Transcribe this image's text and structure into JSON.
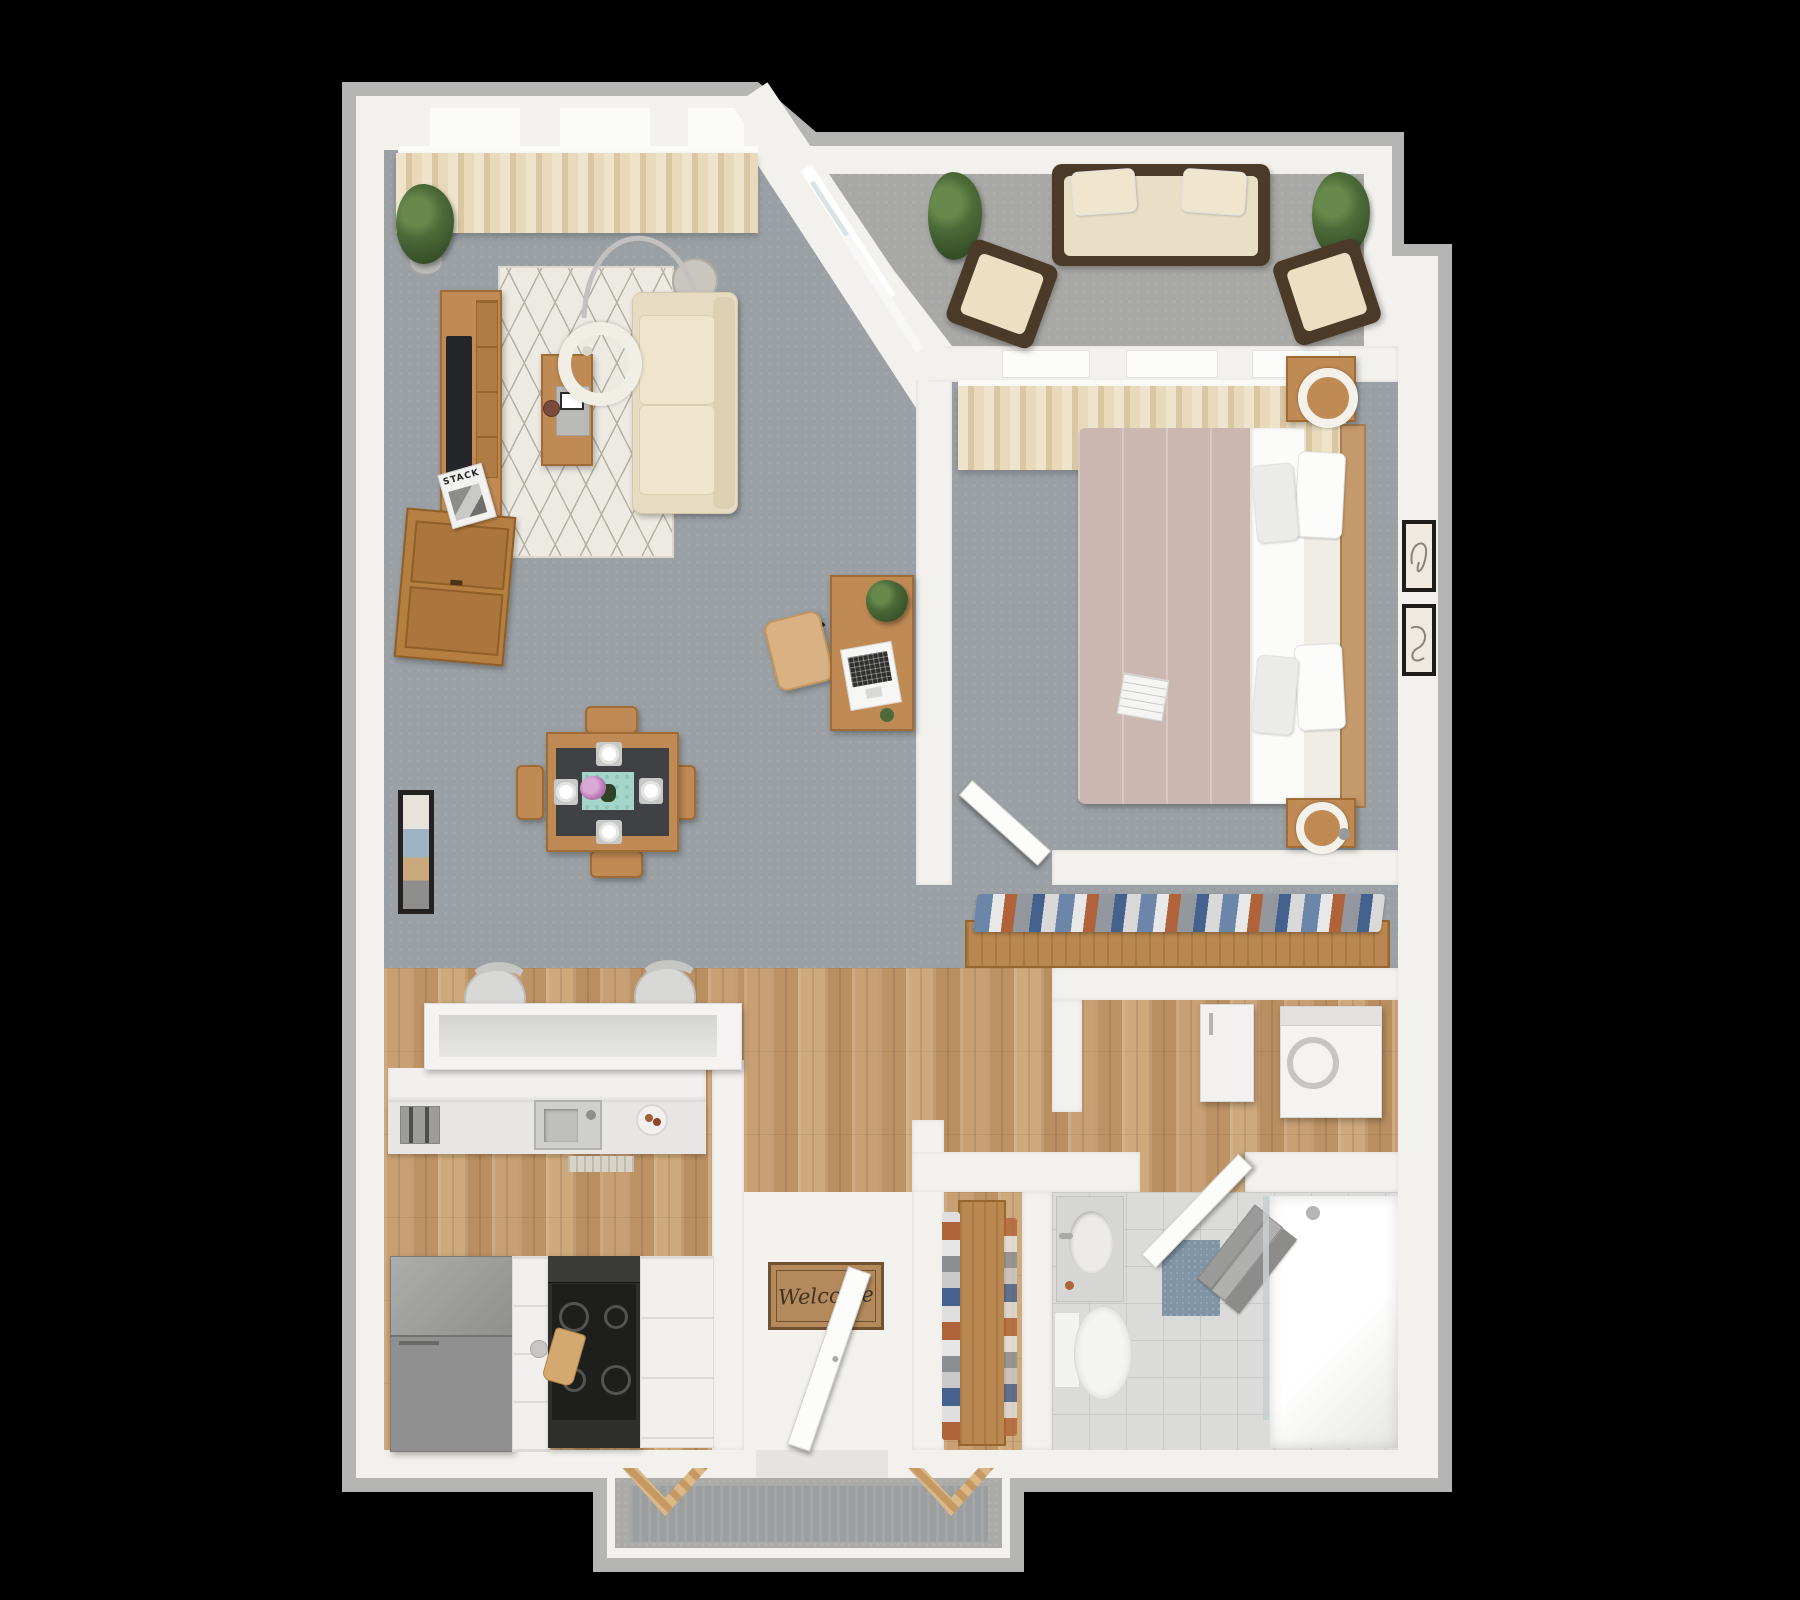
{
  "canvas": {
    "width": 1800,
    "height": 1600,
    "background": "#000000"
  },
  "labels": {
    "welcome_mat": "Welcome",
    "magazine_masthead": "STACK"
  },
  "palette": {
    "exterior_band": "#b5b5b3",
    "interior_wall": "#f3f1ee",
    "carpet_gray": "#9aa0a4",
    "balcony_carpet": "#a8a8a6",
    "wood_floor": "#c49a6e",
    "bathroom_tile": "#dbdbd9",
    "patio_concrete": "#ababa9",
    "wood_furniture": "#c08a54",
    "sofa_cream": "#eae0c8",
    "curtain_beige": "#e7d9ba",
    "duvet_mauve": "#cbb6b0",
    "runner_teal": "#a5d5c9",
    "bath_mat_blue": "#8195a6",
    "wicker_brown": "#4c3a28",
    "stove_black": "#1e1e1c",
    "appliance_gray": "#909090"
  },
  "scene": {
    "type": "3d-floor-plan-render",
    "view": "top-down"
  },
  "rooms": {
    "living_room": [
      "curtained-windows",
      "potted-plant",
      "tv-console",
      "tv",
      "magazine-stack",
      "sideboard",
      "area-rug",
      "coffee-table",
      "arc-floor-lamp",
      "side-table",
      "sofa",
      "wall-art"
    ],
    "dining_area": [
      {
        "item": "dining-table",
        "count": 1
      },
      {
        "item": "dining-chair",
        "count": 4
      },
      {
        "item": "place-setting",
        "count": 4
      },
      {
        "item": "flower-centerpiece",
        "count": 1
      },
      {
        "item": "table-runner",
        "count": 1
      }
    ],
    "office_nook": [
      "desk",
      "desk-chair",
      "laptop",
      "potted-plant",
      "succulent"
    ],
    "balcony": [
      {
        "item": "outdoor-sofa",
        "count": 1
      },
      {
        "item": "outdoor-chair",
        "count": 2
      },
      {
        "item": "potted-plant",
        "count": 2
      },
      {
        "item": "sliding-glass-door",
        "count": 1
      }
    ],
    "bedroom": [
      "curtained-windows",
      "double-bed",
      {
        "item": "pillow",
        "count": 4
      },
      {
        "item": "nightstand",
        "count": 2
      },
      {
        "item": "table-lamp",
        "count": 2
      },
      {
        "item": "wall-art",
        "count": 2
      },
      "magazine",
      "door"
    ],
    "walk_in_closet": [
      "clothes-rail",
      "hanging-clothes"
    ],
    "kitchen": [
      "breakfast-bar",
      {
        "item": "bar-stool",
        "count": 2
      },
      "sink",
      "faucet",
      "toaster",
      "fruit-bowl",
      "kitchen-mat",
      "refrigerator",
      "stove",
      "cutting-board",
      "cabinets"
    ],
    "entry": [
      "front-door",
      "welcome-mat"
    ],
    "hallway": [
      "shoe-rack",
      "shoes"
    ],
    "laundry_nook": [
      "washer",
      "cabinet"
    ],
    "bathroom": [
      "door",
      "vanity-sink",
      "toilet",
      "bath-mat",
      "towel-rail",
      "walk-in-shower",
      "shower-glass"
    ],
    "patio": [
      "outdoor-rug",
      {
        "item": "bench",
        "count": 2
      }
    ]
  }
}
